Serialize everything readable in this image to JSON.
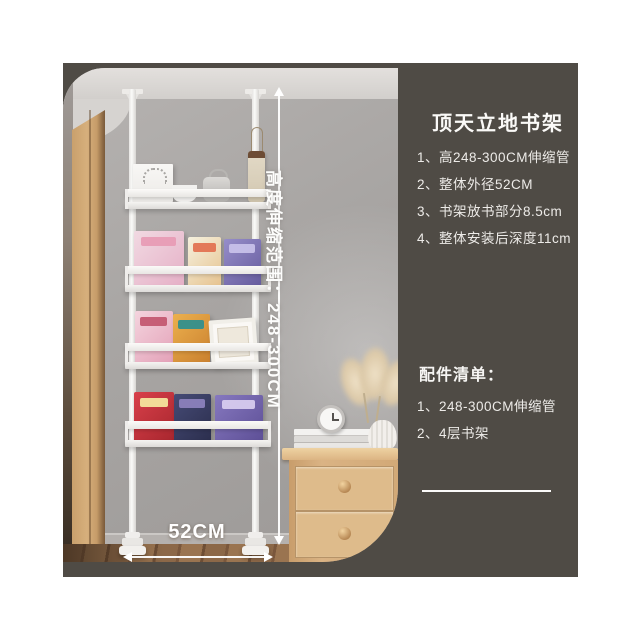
{
  "product_info": {
    "title": "顶天立地书架",
    "specs": [
      "1、高248-300CM伸缩管",
      "2、整体外径52CM",
      "3、书架放书部分8.5cm",
      "4、整体安装后深度11cm"
    ],
    "accessories_title": "配件清单：",
    "accessories": [
      "1、248-300CM伸缩管",
      "2、4层书架"
    ]
  },
  "annotations": {
    "height_range_label": "高度伸缩范围：248-300CM",
    "width_label": "52CM"
  },
  "colors": {
    "panel_background": "#4f4b45",
    "text": "#f5f4f2",
    "annotation_arrows": "#ffffff",
    "shelf_white": "#f3f2f0"
  },
  "scene": {
    "books": [
      {
        "shelf": 2,
        "x": 71,
        "y": 163,
        "w": 50,
        "h": 56,
        "c1": "#f1d9e2",
        "c2": "#e5afc6",
        "stripe": "#e79ab4"
      },
      {
        "shelf": 2,
        "x": 125,
        "y": 169,
        "w": 33,
        "h": 50,
        "c1": "#f5f1df",
        "c2": "#e6c28e",
        "stripe": "#e2704f"
      },
      {
        "shelf": 2,
        "x": 161,
        "y": 171,
        "w": 37,
        "h": 48,
        "c1": "#968dc9",
        "c2": "#655b9d",
        "stripe": "#c9c2ea"
      },
      {
        "shelf": 3,
        "x": 72,
        "y": 243,
        "w": 38,
        "h": 54,
        "c1": "#f4d4de",
        "c2": "#e3a0b7",
        "stripe": "#c2566f"
      },
      {
        "shelf": 3,
        "x": 110,
        "y": 246,
        "w": 37,
        "h": 51,
        "c1": "#ecb04e",
        "c2": "#c97f2e",
        "stripe": "#2e8f8f"
      },
      {
        "shelf": 3,
        "x": 147,
        "y": 251,
        "w": 47,
        "h": 46,
        "type": "frame"
      },
      {
        "shelf": 4,
        "x": 71,
        "y": 324,
        "w": 40,
        "h": 50,
        "c1": "#d8404a",
        "c2": "#a8262e",
        "stripe": "#f5e9a0"
      },
      {
        "shelf": 4,
        "x": 111,
        "y": 326,
        "w": 37,
        "h": 48,
        "c1": "#464b76",
        "c2": "#2b2e4d",
        "stripe": "#8d82be"
      },
      {
        "shelf": 4,
        "x": 152,
        "y": 327,
        "w": 48,
        "h": 47,
        "c1": "#8678bf",
        "c2": "#5d4f96",
        "stripe": "#d9cef0"
      }
    ]
  }
}
